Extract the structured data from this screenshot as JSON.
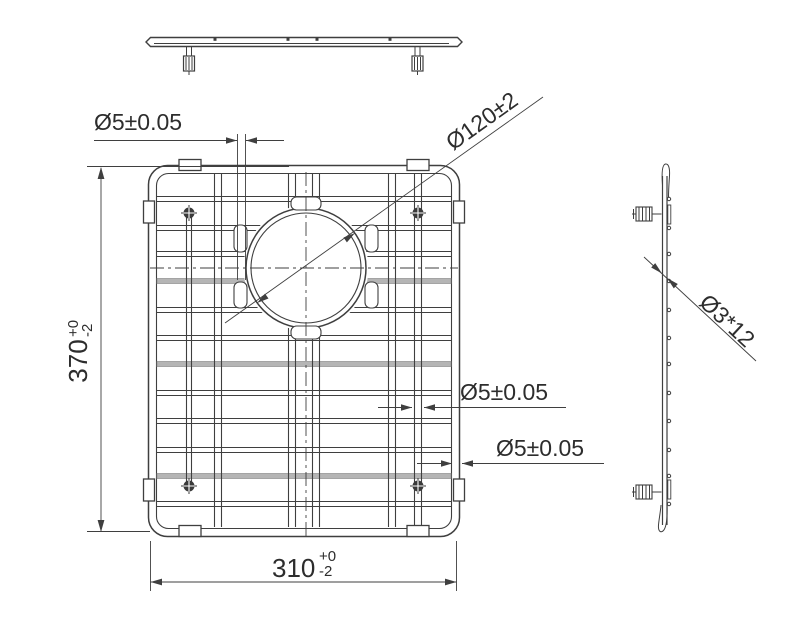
{
  "drawing": {
    "labels": {
      "wire_dia_top": "Ø5±0.05",
      "hole_dia": "Ø120±2",
      "height_value": "370",
      "height_tol_upper": "+0",
      "height_tol_lower": "-2",
      "width_value": "310",
      "width_tol_upper": "+0",
      "width_tol_lower": "-2",
      "wire_dia_mid": "Ø5±0.05",
      "wire_dia_frame": "Ø5±0.05",
      "side_wire_dia": "Ø3*12"
    },
    "colors": {
      "line": "#3f3f3f",
      "text": "#2d2d2d",
      "light_wire": "#b5b5b5",
      "background": "#ffffff"
    }
  }
}
